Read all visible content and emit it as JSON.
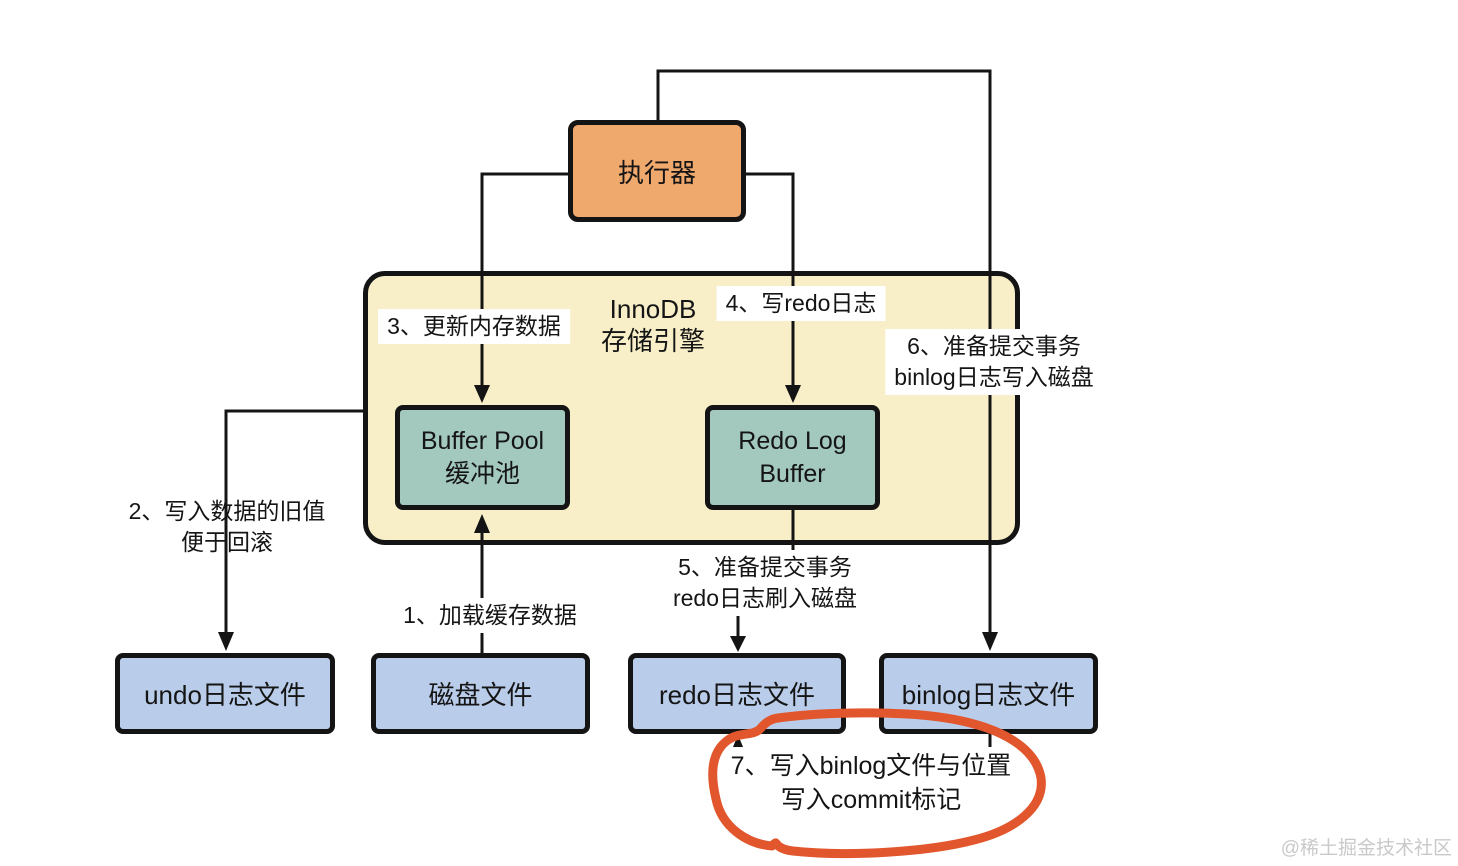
{
  "diagram": {
    "title_context": "MySQL InnoDB update flow diagram",
    "nodes": {
      "executor": {
        "label": "执行器"
      },
      "innodb_engine": {
        "line1": "InnoDB",
        "line2": "存储引擎"
      },
      "buffer_pool": {
        "line1": "Buffer Pool",
        "line2": "缓冲池"
      },
      "redo_log_buffer": {
        "line1": "Redo Log",
        "line2": "Buffer"
      },
      "undo_file": {
        "label": "undo日志文件"
      },
      "disk_file": {
        "label": "磁盘文件"
      },
      "redo_file": {
        "label": "redo日志文件"
      },
      "binlog_file": {
        "label": "binlog日志文件"
      }
    },
    "steps": {
      "step1": {
        "line1": "1、加载缓存数据"
      },
      "step2": {
        "line1": "2、写入数据的旧值",
        "line2": "便于回滚"
      },
      "step3": {
        "line1": "3、更新内存数据"
      },
      "step4": {
        "line1": "4、写redo日志"
      },
      "step5": {
        "line1": "5、准备提交事务",
        "line2": "redo日志刷入磁盘"
      },
      "step6": {
        "line1": "6、准备提交事务",
        "line2": "binlog日志写入磁盘"
      },
      "step7": {
        "line1": "7、写入binlog文件与位置",
        "line2": "写入commit标记"
      }
    },
    "edges": [
      {
        "from": "disk_file",
        "to": "buffer_pool",
        "step": "1"
      },
      {
        "from": "innodb_engine",
        "to": "undo_file",
        "step": "2"
      },
      {
        "from": "executor",
        "to": "buffer_pool",
        "step": "3"
      },
      {
        "from": "executor",
        "to": "redo_log_buffer",
        "step": "4"
      },
      {
        "from": "redo_log_buffer",
        "to": "redo_file",
        "step": "5"
      },
      {
        "from": "executor",
        "to": "binlog_file",
        "step": "6"
      },
      {
        "from": "binlog_file",
        "to": "redo_file",
        "step": "7"
      }
    ],
    "colors": {
      "executor_fill": "#f0a96d",
      "engine_fill": "#f8efc8",
      "buffer_fill": "#a3c8be",
      "file_fill": "#b9cdea",
      "border": "#141414",
      "line": "#141414",
      "highlight_circle": "#e2562d",
      "watermark_text": "#c9c9c9"
    },
    "watermark": "@稀土掘金技术社区"
  }
}
